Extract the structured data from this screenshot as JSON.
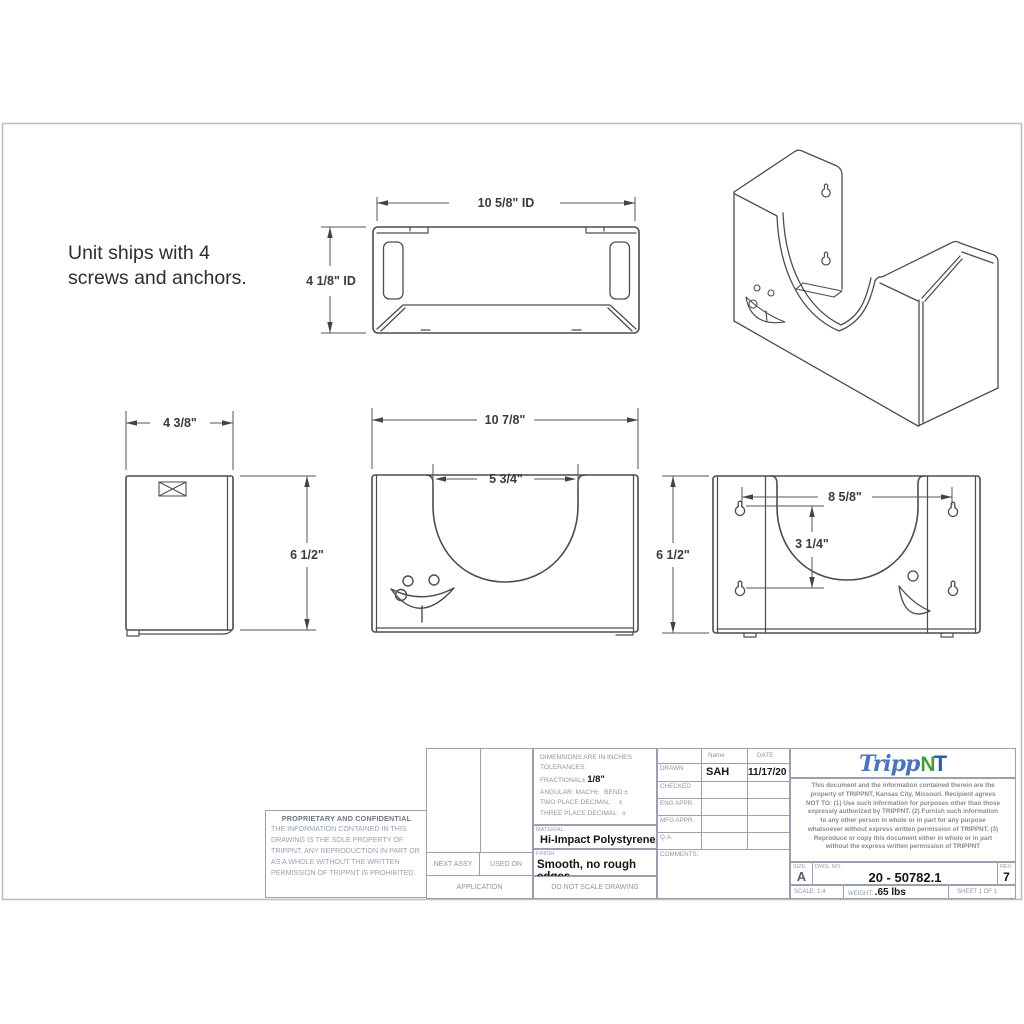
{
  "note": "Unit ships with 4 screws and anchors.",
  "dims": {
    "top_width": "10 5/8\" ID",
    "top_depth": "4 1/8\" ID",
    "side_width": "4 3/8\"",
    "front_width": "10 7/8\"",
    "front_cutout": "5 3/4\"",
    "height_left": "6 1/2\"",
    "height_right": "6 1/2\"",
    "keyhole_span": "8 5/8\"",
    "keyhole_rise": "3 1/4\""
  },
  "title_block": {
    "proprietary": {
      "title": "PROPRIETARY AND CONFIDENTIAL",
      "body": "THE INFORMATION CONTAINED IN THIS DRAWING IS THE SOLE PROPERTY OF TRIPPNT.  ANY REPRODUCTION IN PART OR AS A WHOLE WITHOUT THE WRITTEN PERMISSION OF TRIPPNT IS PROHIBITED."
    },
    "application": {
      "next_assy": "NEXT ASSY",
      "used_on": "USED ON",
      "application": "APPLICATION"
    },
    "tolerances": {
      "l1": "DIMENSIONS ARE IN INCHES",
      "l2": "TOLERANCES:",
      "l3_label": "FRACTIONAL± ",
      "l3_value": "1/8\"",
      "l4": "ANGULAR: MACH±   BEND ±",
      "l5": "TWO PLACE DECIMAL     ±",
      "l6": "THREE PLACE DECIMAL   ±"
    },
    "material": {
      "label": "MATERIAL",
      "value": "Hi-Impact Polystyrene"
    },
    "finish": {
      "label": "FINISH",
      "value": "Smooth, no rough edges"
    },
    "do_not_scale": "DO  NOT  SCALE  DRAWING",
    "approval": {
      "name_header": "Name",
      "date_header": "DATE",
      "rows": [
        {
          "label": "DRAWN",
          "name": "SAH",
          "date": "11/17/20"
        },
        {
          "label": "CHECKED",
          "name": "",
          "date": ""
        },
        {
          "label": "ENG APPR.",
          "name": "",
          "date": ""
        },
        {
          "label": "MFG APPR.",
          "name": "",
          "date": ""
        },
        {
          "label": "Q.A.",
          "name": "",
          "date": ""
        }
      ],
      "comments_label": "COMMENTS:"
    },
    "logo": {
      "script": "Tripp",
      "n": "N",
      "t": "T"
    },
    "legal": "This document and the information contained therein are the property of TRIPPNT, Kansas City, Missouri. Recipient agrees NOT TO: (1) Use such information for purposes other than those expressly authorized by TRIPPNT. (2) Furnish such information to any other person in whole or in part for any purpose whatsoever without express  written permission of TRIPPNT. (3) Reproduce or copy this document either in whole or in part without the express written permission of TRIPPNT",
    "size": {
      "label": "SIZE",
      "value": "A"
    },
    "dwg_no": {
      "label": "DWG.  NO.",
      "value": "20 - 50782.1"
    },
    "rev": {
      "label": "REV.",
      "value": "7"
    },
    "scale": {
      "label": "SCALE: 1:4"
    },
    "weight": {
      "label": "WEIGHT: ",
      "value": ".65 lbs"
    },
    "sheet": {
      "label": "SHEET 1 OF 1"
    }
  },
  "colors": {
    "line": "#4d4d4d",
    "border": "#9aa0ad",
    "logo_blue": "#4a74bc",
    "logo_green": "#3f9f3f",
    "logo_dark_blue": "#2b5fad"
  }
}
